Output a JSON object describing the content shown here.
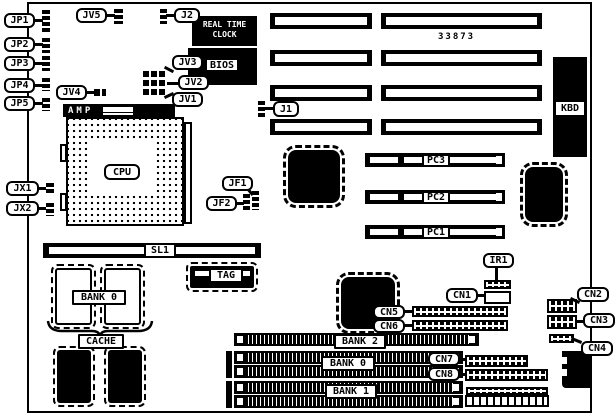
{
  "part_number": "33873",
  "labels": {
    "jp1": "JP1",
    "jp2": "JP2",
    "jp3": "JP3",
    "jp4": "JP4",
    "jp5": "JP5",
    "jv1": "JV1",
    "jv2": "JV2",
    "jv3": "JV3",
    "jv4": "JV4",
    "jv5": "JV5",
    "j1": "J1",
    "j2": "J2",
    "rtc_line1": "REAL TIME",
    "rtc_line2": "CLOCK",
    "bios": "BIOS",
    "amp": "AMP",
    "cpu": "CPU",
    "kbd": "KBD",
    "jf1": "JF1",
    "jf2": "JF2",
    "jx1": "JX1",
    "jx2": "JX2",
    "pc1": "PC1",
    "pc2": "PC2",
    "pc3": "PC3",
    "sl1": "SL1",
    "tag": "TAG",
    "cache": "CACHE",
    "bank0_cache": "BANK 0",
    "bank2_simm": "BANK 2",
    "bank0_simm": "BANK 0",
    "bank1_simm": "BANK 1",
    "ir1": "IR1",
    "cn1": "CN1",
    "cn2": "CN2",
    "cn3": "CN3",
    "cn4": "CN4",
    "cn5": "CN5",
    "cn6": "CN6",
    "cn7": "CN7",
    "cn8": "CN8"
  }
}
